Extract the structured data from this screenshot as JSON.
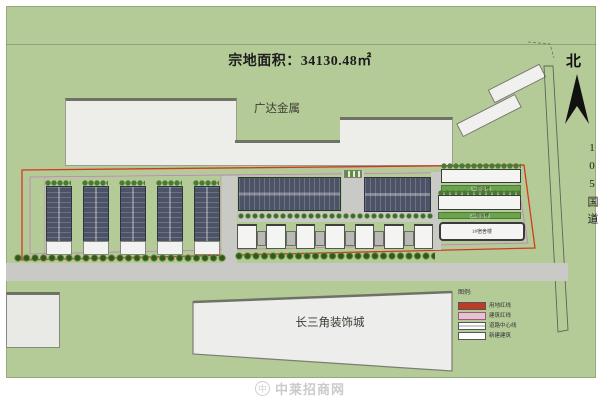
{
  "title": "宗地面积：34130.48㎡",
  "north_label": "北",
  "road_label": "105国道",
  "neighbors": {
    "top": "广达金属",
    "bottom": "长三角装饰城"
  },
  "site": {
    "lawn_strip_1_label": "3#宿舍楼",
    "lawn_strip_2_label": "2#宿舍楼",
    "dorm_building_label": "1#宿舍楼"
  },
  "legend": {
    "title": "图例:",
    "items": [
      {
        "label": "用地红线",
        "color": "#c03a28"
      },
      {
        "label": "建筑红线",
        "color": "#e3c3cf"
      },
      {
        "label": "道路中心线",
        "color": "#ffffff"
      },
      {
        "label": "新建建筑",
        "color": "#ffffff"
      }
    ]
  },
  "watermark": "中莱招商网",
  "colors": {
    "ground_green": "#b5cb97",
    "parcel_red_line": "#cf3b22",
    "building_magenta_line": "#c878c8",
    "workshop_roof": "#4d5366",
    "lawn_green": "#6aa34c",
    "road_gray": "#c9c9c5",
    "neighbor_building_gray": "#ededea"
  }
}
